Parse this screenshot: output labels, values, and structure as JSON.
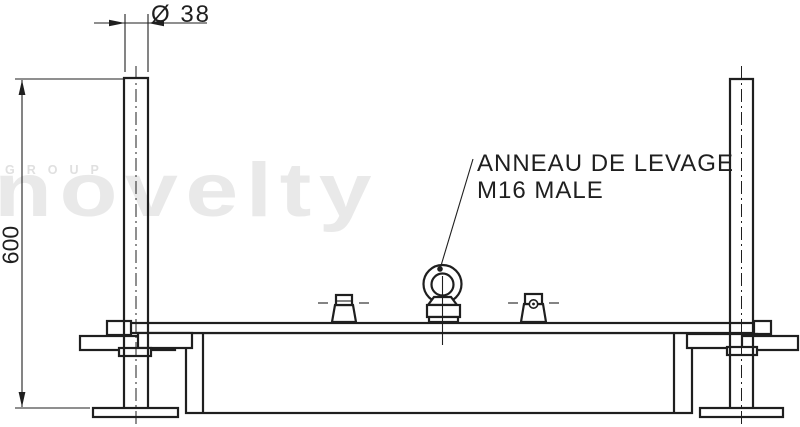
{
  "drawing": {
    "callout": {
      "line1": "ANNEAU DE LEVAGE",
      "line2": "M16 MALE"
    },
    "dimensions": {
      "diameter": "Ø 38",
      "height": "600"
    },
    "watermark": {
      "group": "GROUP",
      "brand": "novelty"
    },
    "colors": {
      "line": "#1f1f1f",
      "background": "#ffffff",
      "watermark_light": "#e9e9e9",
      "watermark_dark": "#e0e0e0"
    }
  }
}
